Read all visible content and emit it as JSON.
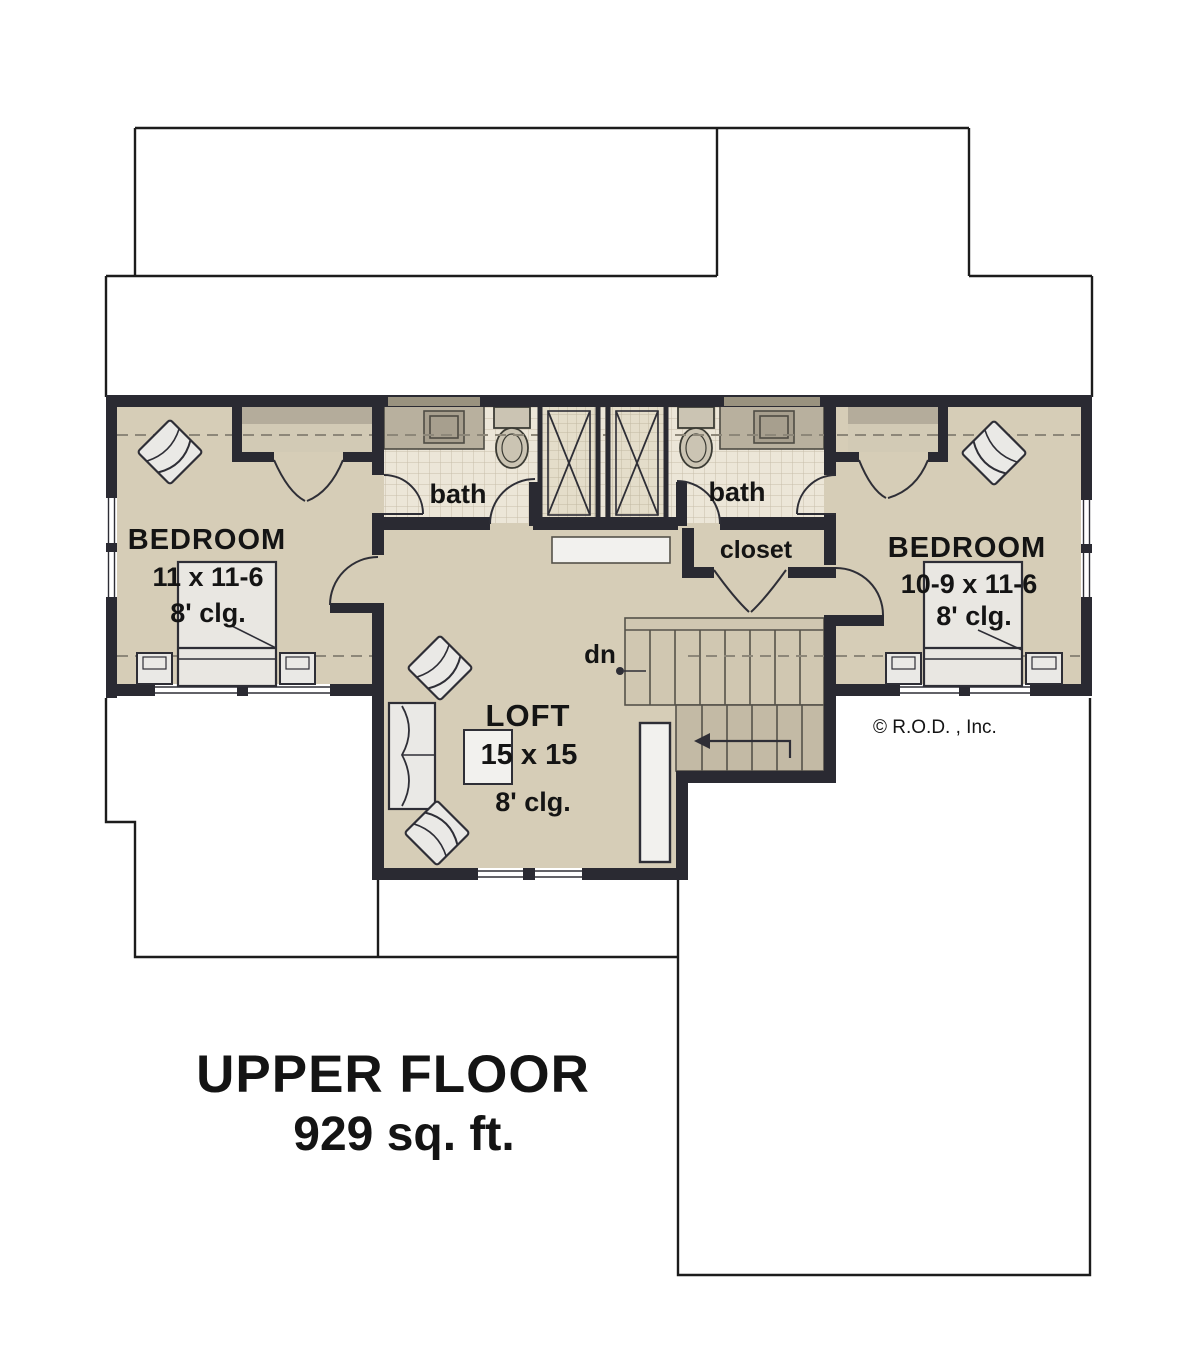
{
  "plan": {
    "rooms": {
      "bedroom_left": {
        "name": "BEDROOM",
        "dims": "11 x 11-6",
        "ceiling": "8' clg."
      },
      "bedroom_right": {
        "name": "BEDROOM",
        "dims": "10-9 x 11-6",
        "ceiling": "8' clg."
      },
      "loft": {
        "name": "LOFT",
        "dims": "15 x 15",
        "ceiling": "8' clg."
      },
      "bath_left": {
        "label": "bath"
      },
      "bath_right": {
        "label": "bath"
      },
      "closet": {
        "label": "closet"
      },
      "stairs": {
        "label": "dn"
      }
    },
    "title": {
      "line1": "UPPER FLOOR",
      "line2": "929 sq. ft."
    },
    "copyright": "© R.O.D. , Inc.",
    "colors": {
      "wall": "#2a2a32",
      "floor": "#d6cdb7",
      "bath_tile": "#ece6d8",
      "shower_tile": "#e4ddca",
      "counter": "#b8b09e",
      "shelf": "#b4ac9b",
      "stair_upper": "#d0c7b1",
      "stair_lower": "#c3baa5",
      "furniture": "#eae9e6",
      "dashed_line": "#8d8779",
      "outline": "#1c1c1c"
    }
  }
}
